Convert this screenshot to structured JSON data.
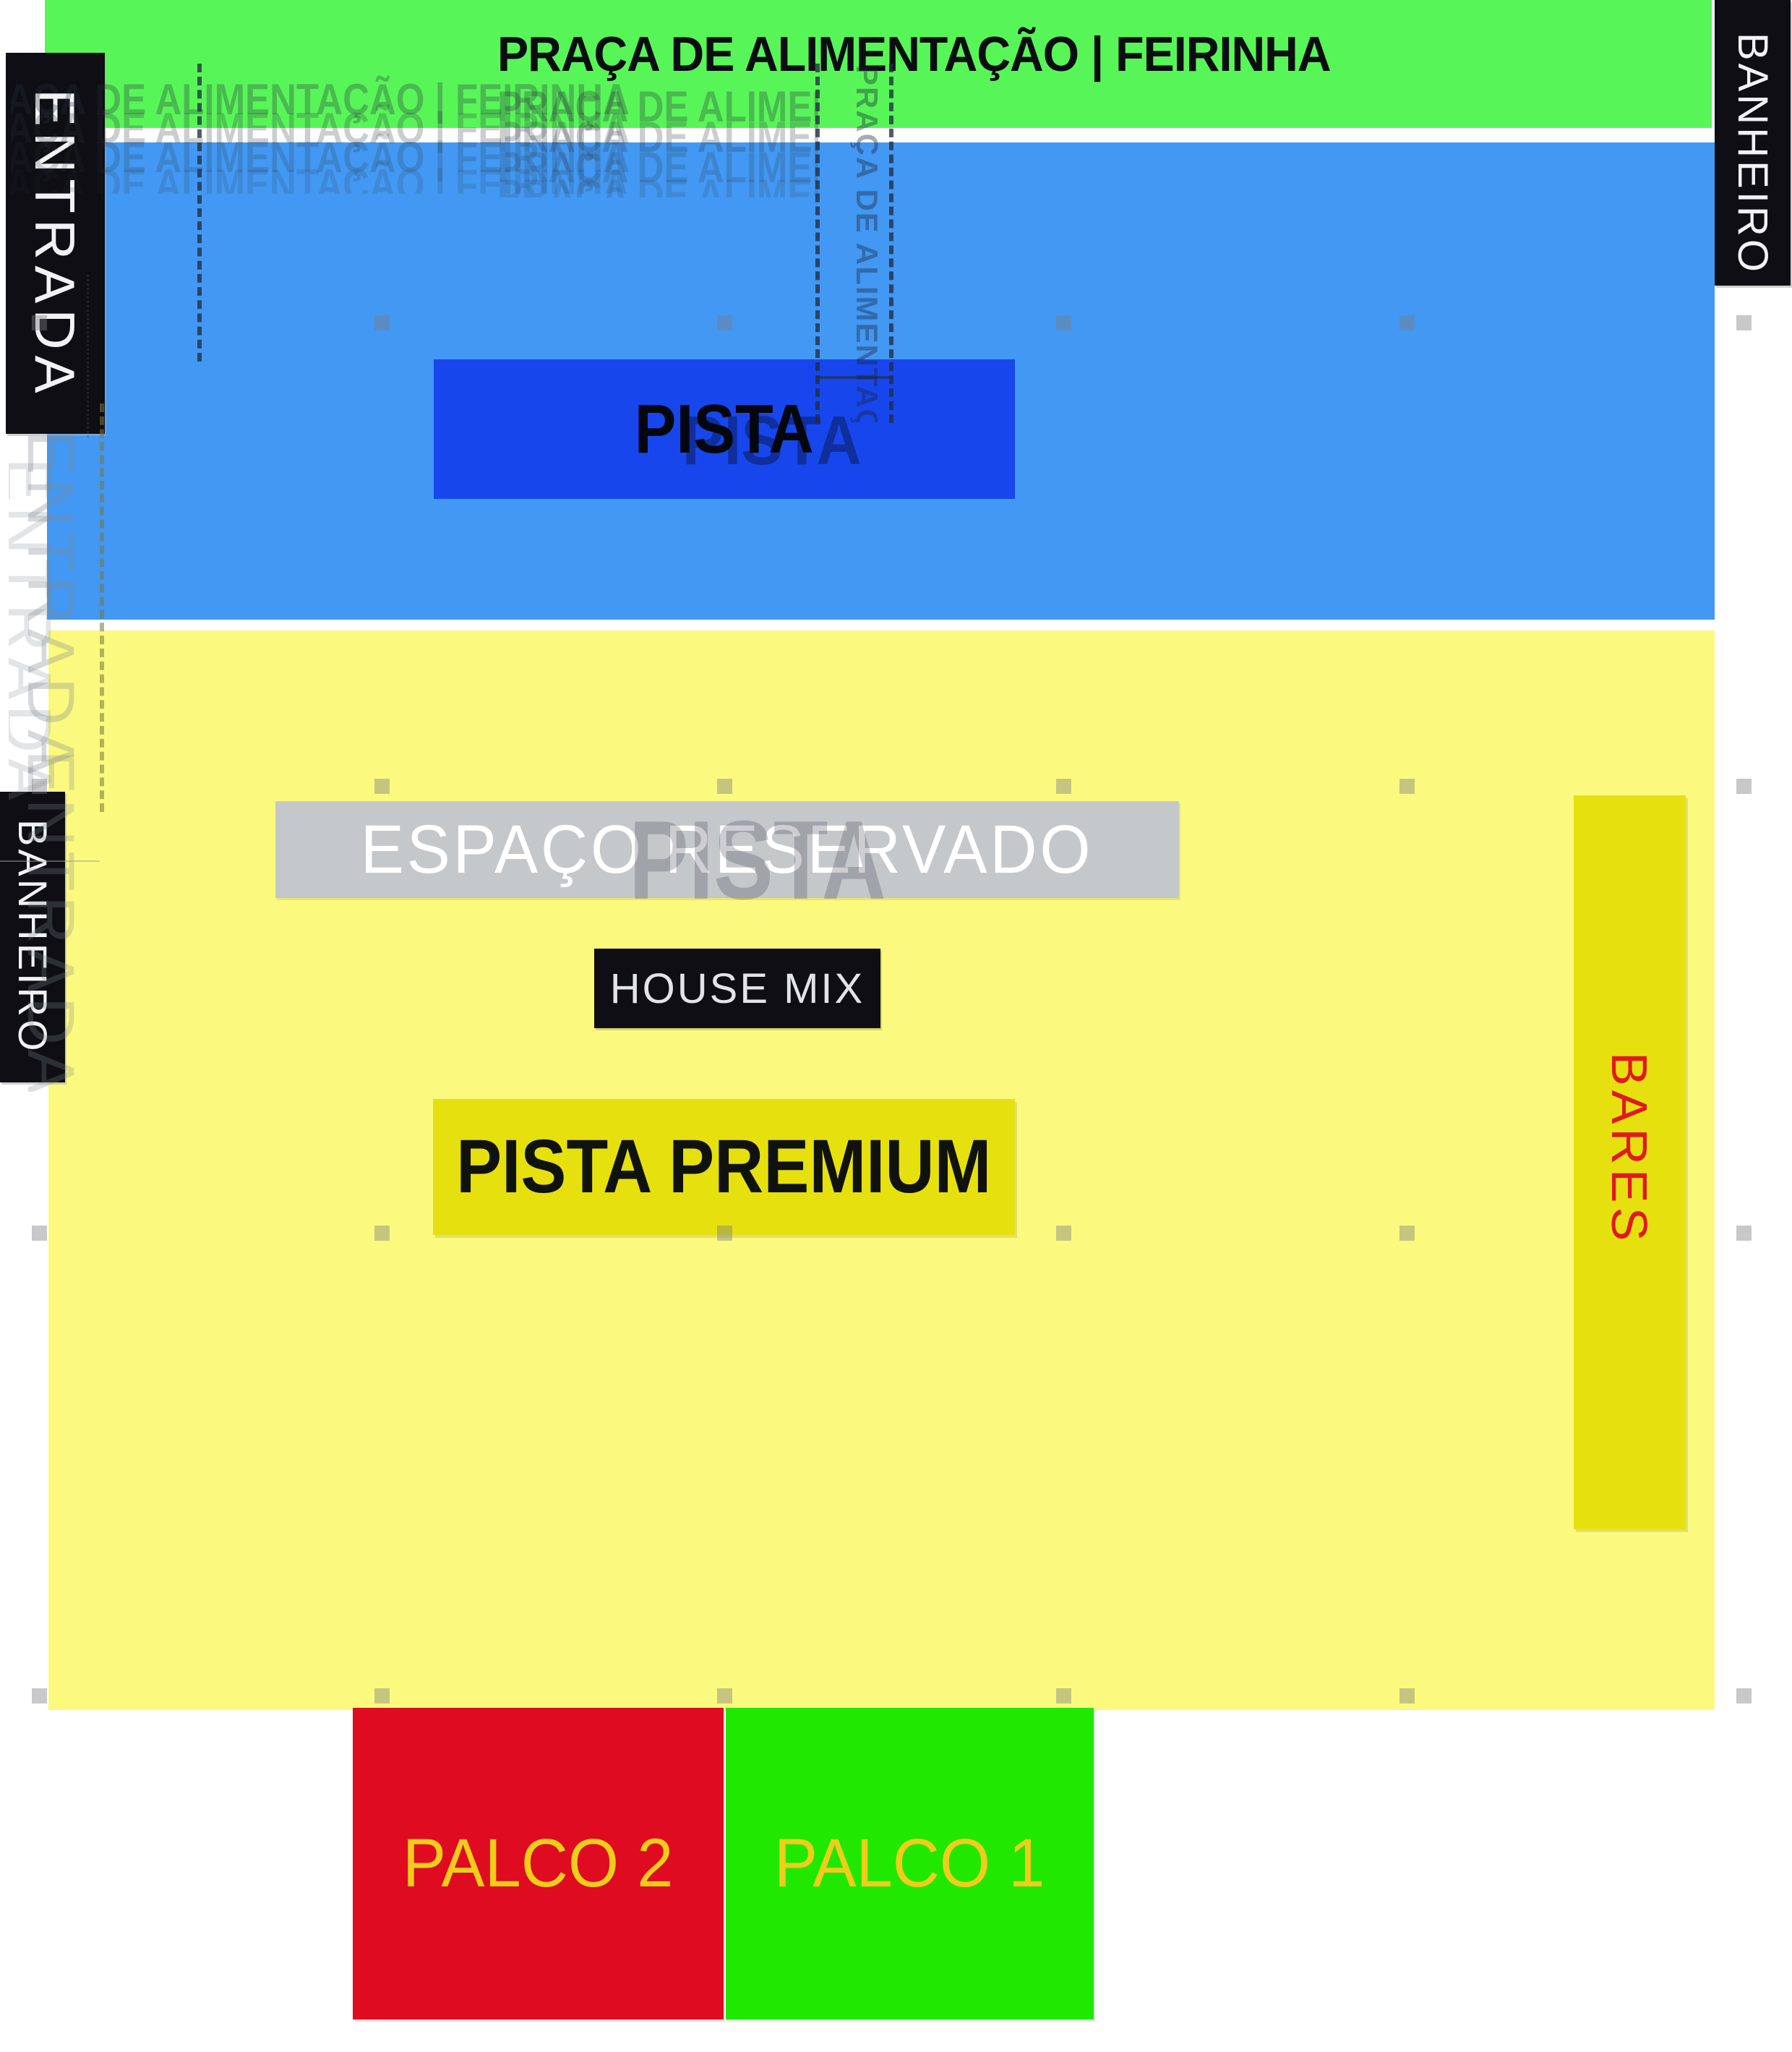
{
  "map": {
    "title": "PRAÇA DE ALIMENTAÇÃO | FEIRINHA",
    "zones": {
      "entrance": "ENTRADA",
      "toilet_top_right": "BANHEIRO",
      "toilet_left": "BANHEIRO",
      "pista": "PISTA",
      "reserved": "ESPAÇO RESERVADO",
      "house_mix": "HOUSE MIX",
      "pista_premium": "PISTA PREMIUM",
      "bars": "BARES",
      "stage_2": "PALCO 2",
      "stage_1": "PALCO 1"
    },
    "ghost_text": {
      "title_echo": "PRAÇA DE ALIMENTAÇÃO | FEIRINHA",
      "pista_echo": "PISTA",
      "entrance_echo": "ENTRADA"
    },
    "colors": {
      "banner-green": "#58f558",
      "field-blue": "#4298f2",
      "pista-blue": "#1747ec",
      "field-yellow": "#fbfa7e",
      "accent-yellow": "#e6e00f",
      "reserved-gray": "#c5c8cb",
      "stage2-red": "#de0b21",
      "stage1-green": "#20e800",
      "label-black": "#0e0e14",
      "bars-red": "#e01a20",
      "stage-label-yellow": "#efcd1a"
    }
  }
}
